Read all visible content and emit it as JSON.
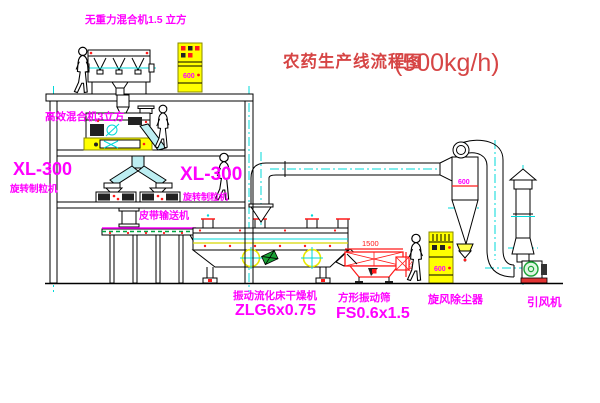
{
  "title": {
    "main": "农药生产线流程图",
    "capacity": "(500kg/h)"
  },
  "equipment_labels": {
    "gravity_mixer": "无重力混合机1.5 立方",
    "high_eff_mixer": "高效混合机3立方",
    "granulator_model_left": "XL-300",
    "granulator_name_left": "旋转制粒机",
    "granulator_model_right": "XL-300",
    "granulator_name_right": "旋转制粒机",
    "belt_conveyor": "皮带输送机",
    "dryer_name": "振动流化床干燥机",
    "dryer_model": "ZLG6x0.75",
    "sieve_name": "方形振动筛",
    "sieve_model": "FS0.6x1.5",
    "cyclone_name": "旋风除尘器",
    "fan_name": "引风机"
  },
  "annotations": {
    "cabinet_top_tag": "600",
    "cabinet_right_tag": "600",
    "cyclone_dim": "600",
    "sieve_width_dim": "1500",
    "sieve_height_dim": "350"
  },
  "colors": {
    "background": "#ffffff",
    "line_black": "#000000",
    "centerline_cyan": "#00d9d9",
    "label_magenta": "#ff00ff",
    "title_red": "#d64545",
    "dimension_red": "#ff1a1a",
    "cabinet_yellow": "#ffff00",
    "conveyor_green": "#00a340"
  }
}
